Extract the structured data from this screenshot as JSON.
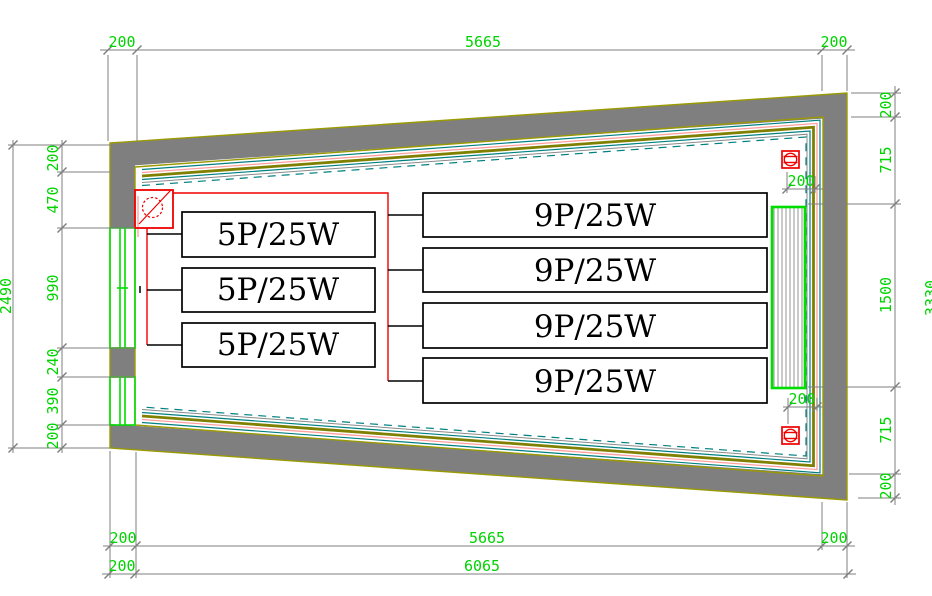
{
  "drawing": {
    "fixtures": {
      "small": [
        "5P/25W",
        "5P/25W",
        "5P/25W"
      ],
      "large": [
        "9P/25W",
        "9P/25W",
        "9P/25W",
        "9P/25W"
      ]
    },
    "dims": {
      "top": [
        "200",
        "5665",
        "200"
      ],
      "bottom1": [
        "200",
        "5665",
        "200"
      ],
      "bottom2": [
        "200",
        "6065"
      ],
      "left_outer": "2490",
      "left_chain": [
        "200",
        "470",
        "990",
        "240",
        "390",
        "200"
      ],
      "right_chain": [
        "200",
        "715",
        "1500",
        "715",
        "200"
      ],
      "right_overall": "3330",
      "vent_top": "200",
      "vent_bottom": "200"
    },
    "palette": {
      "dimension_green": "#00d400",
      "window_green": "#00dd00",
      "wall_gray": "#7f7f7f",
      "wall_edge_olive": "#9a9a00",
      "cable_teal": "#008080",
      "cable_pink": "#ff9f9f",
      "cable_olive": "#808000",
      "wiring_red": "#ee0000",
      "line_black": "#000000"
    }
  }
}
